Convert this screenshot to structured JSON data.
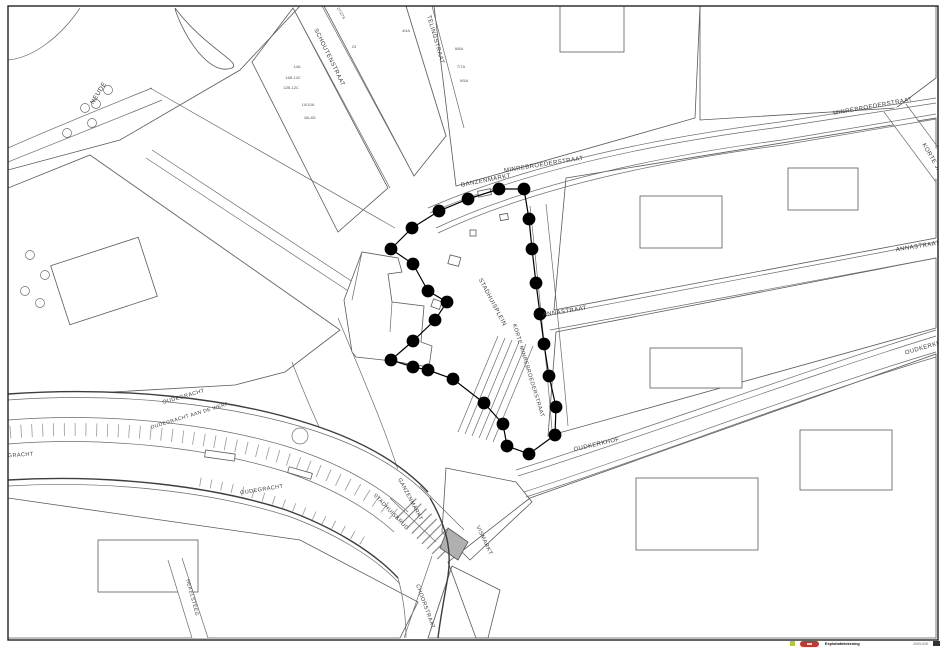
{
  "map": {
    "frame_color": "#222222",
    "boundary": {
      "dot_color": "#000000",
      "dot_radius": 6.4,
      "line_width": 1.2,
      "points": [
        [
          391,
          249
        ],
        [
          412,
          228
        ],
        [
          439,
          211
        ],
        [
          468,
          199
        ],
        [
          499,
          189
        ],
        [
          524,
          189
        ],
        [
          529,
          219
        ],
        [
          532,
          249
        ],
        [
          536,
          283
        ],
        [
          540,
          314
        ],
        [
          544,
          344
        ],
        [
          549,
          376
        ],
        [
          556,
          407
        ],
        [
          555,
          435
        ],
        [
          529,
          454
        ],
        [
          507,
          446
        ],
        [
          503,
          424
        ],
        [
          484,
          403
        ],
        [
          453,
          379
        ],
        [
          428,
          370
        ],
        [
          413,
          367
        ],
        [
          391,
          360
        ],
        [
          413,
          341
        ],
        [
          435,
          320
        ],
        [
          447,
          302
        ],
        [
          428,
          291
        ],
        [
          413,
          264
        ]
      ]
    },
    "streets": [
      {
        "text": "NEUDE",
        "x": 100,
        "y": 94,
        "rot": -58,
        "size": 6.5
      },
      {
        "text": "SCHOUTENSTRAAT",
        "x": 328,
        "y": 58,
        "rot": 64,
        "size": 6
      },
      {
        "text": "TELINGSTRAAT",
        "x": 434,
        "y": 40,
        "rot": 74,
        "size": 6
      },
      {
        "text": "GANZENMARKT",
        "x": 486,
        "y": 182,
        "rot": -11,
        "size": 6
      },
      {
        "text": "MINREBROEDERSTRAAT",
        "x": 544,
        "y": 166,
        "rot": -9,
        "size": 6
      },
      {
        "text": "MINREBROEDERSTRAAT",
        "x": 873,
        "y": 108,
        "rot": -10,
        "size": 6
      },
      {
        "text": "KORTE JANSTRAAT",
        "x": 938,
        "y": 172,
        "rot": 60,
        "size": 6
      },
      {
        "text": "ANNASTRAAT",
        "x": 918,
        "y": 248,
        "rot": -9,
        "size": 6
      },
      {
        "text": "ANNASTRAAT",
        "x": 565,
        "y": 313,
        "rot": -9,
        "size": 6
      },
      {
        "text": "STADHUISPLEIN",
        "x": 491,
        "y": 303,
        "rot": 62,
        "size": 6
      },
      {
        "text": "KORTE MINREBROEDERSTRAAT",
        "x": 527,
        "y": 371,
        "rot": 73,
        "size": 5.5
      },
      {
        "text": "OUDKERKHOF",
        "x": 597,
        "y": 446,
        "rot": -13,
        "size": 6
      },
      {
        "text": "OUDKERKHOF",
        "x": 928,
        "y": 348,
        "rot": -16,
        "size": 6
      },
      {
        "text": "OUDEGRACHT",
        "x": 184,
        "y": 398,
        "rot": -16,
        "size": 5.5
      },
      {
        "text": "OUDEGRACHT AAN DE WERF",
        "x": 190,
        "y": 417,
        "rot": -17,
        "size": 5
      },
      {
        "text": "OUDEGRACHT",
        "x": 12,
        "y": 457,
        "rot": -4,
        "size": 5.5
      },
      {
        "text": "OUDEGRACHT",
        "x": 262,
        "y": 491,
        "rot": -9,
        "size": 5.5
      },
      {
        "text": "STADHUISBRUG",
        "x": 390,
        "y": 513,
        "rot": 46,
        "size": 5.5
      },
      {
        "text": "GANZENMARKT",
        "x": 409,
        "y": 500,
        "rot": 62,
        "size": 5.5
      },
      {
        "text": "VISMARKT",
        "x": 483,
        "y": 541,
        "rot": 65,
        "size": 5.5
      },
      {
        "text": "CHOORSTRAAT",
        "x": 424,
        "y": 607,
        "rot": 70,
        "size": 5.5
      },
      {
        "text": "HEKELSTEEG",
        "x": 191,
        "y": 598,
        "rot": 75,
        "size": 5
      }
    ],
    "parcels": [
      {
        "text": "27/27A",
        "x": 340,
        "y": 14,
        "rot": 60
      },
      {
        "text": "23",
        "x": 354,
        "y": 48,
        "rot": 0
      },
      {
        "text": "14A",
        "x": 297,
        "y": 68,
        "rot": 0
      },
      {
        "text": "14B-14C",
        "x": 293,
        "y": 79,
        "rot": 0
      },
      {
        "text": "12B-12C",
        "x": 291,
        "y": 89,
        "rot": 0
      },
      {
        "text": "10/10A",
        "x": 308,
        "y": 106,
        "rot": 0
      },
      {
        "text": "8A-8D",
        "x": 310,
        "y": 119,
        "rot": 0
      },
      {
        "text": "4/4A",
        "x": 406,
        "y": 32,
        "rot": 0
      },
      {
        "text": "8/8A",
        "x": 459,
        "y": 50,
        "rot": 0
      },
      {
        "text": "7/7A",
        "x": 461,
        "y": 68,
        "rot": 0
      },
      {
        "text": "5/5A",
        "x": 464,
        "y": 82,
        "rot": 0
      }
    ],
    "trees": [
      [
        85,
        108
      ],
      [
        96,
        104
      ],
      [
        108,
        90
      ],
      [
        92,
        123
      ],
      [
        67,
        133
      ],
      [
        30,
        255
      ],
      [
        45,
        275
      ],
      [
        25,
        291
      ],
      [
        40,
        303
      ]
    ],
    "legend": {
      "swatch_color": "#b8c832",
      "logo_color": "#c03a2b",
      "title": "Exploitatietekening",
      "ref": "2009-026"
    }
  }
}
